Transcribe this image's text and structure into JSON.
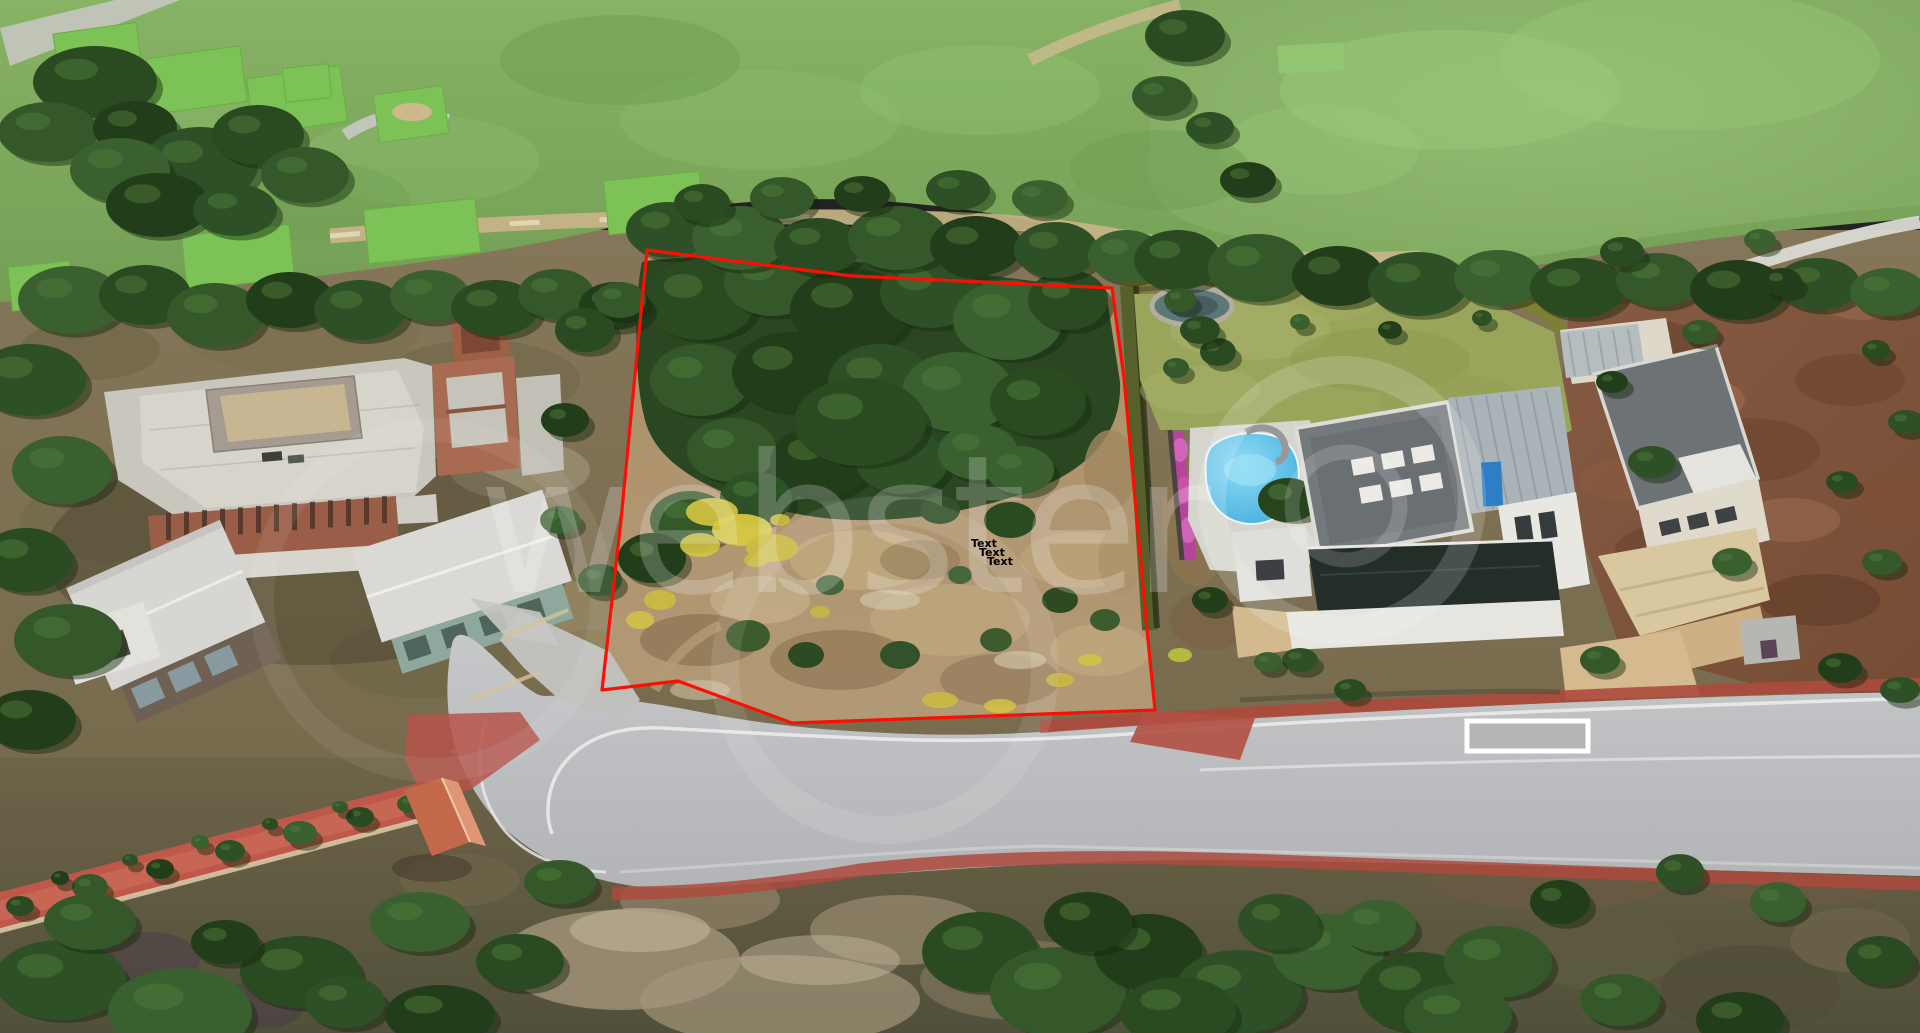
{
  "page": {
    "title": "Aerial property view",
    "width": 1920,
    "height": 1033
  },
  "watermark": {
    "text": "webster",
    "color": "#ffffff"
  },
  "plot_annotation": {
    "boundary_points": "647,250 852,276 1112,288 1124,378 1147,630 1155,710 792,723 678,681 602,690 621,520",
    "boundary_color": "#fb0f05",
    "label_color": "#000000",
    "labels": [
      {
        "text": "Text",
        "x": 971,
        "y": 547
      },
      {
        "text": "Text",
        "x": 979,
        "y": 556
      },
      {
        "text": "Text",
        "x": 987,
        "y": 565
      }
    ]
  },
  "road_annotation": {
    "redaction_box": {
      "x": 1467,
      "y": 721,
      "width": 121,
      "height": 30,
      "fill": "#b5b5b5",
      "border": "#ffffff"
    }
  }
}
